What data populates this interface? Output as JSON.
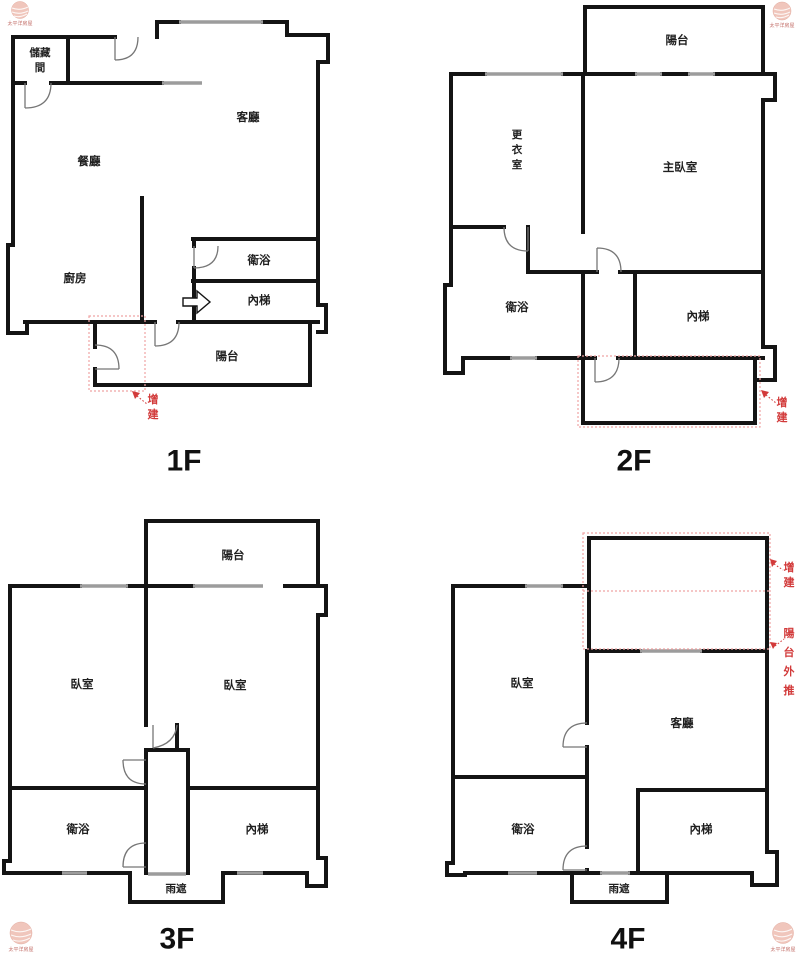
{
  "watermark": {
    "label": "太平洋房屋"
  },
  "colors": {
    "wall": "#141414",
    "window": "#9c9c9c",
    "annotation_red": "#d23a3a",
    "dashed_red": "#efa3a3",
    "watermark_pink": "#f0c6bc"
  },
  "floors": [
    {
      "floor_label": "1F",
      "rooms": {
        "storage": {
          "label": "儲藏間",
          "lines": [
            "儲藏",
            "間"
          ]
        },
        "living": {
          "label": "客廳"
        },
        "dining": {
          "label": "餐廳"
        },
        "kitchen": {
          "label": "廚房"
        },
        "bath": {
          "label": "衛浴"
        },
        "stairs": {
          "label": "內梯"
        },
        "balcony": {
          "label": "陽台"
        }
      },
      "annotations": {
        "addition": {
          "label": "增建",
          "lines": [
            "增",
            "建"
          ]
        }
      }
    },
    {
      "floor_label": "2F",
      "rooms": {
        "balcony": {
          "label": "陽台"
        },
        "dressing": {
          "label": "更衣室",
          "lines": [
            "更",
            "衣",
            "室"
          ]
        },
        "master": {
          "label": "主臥室"
        },
        "bath": {
          "label": "衛浴"
        },
        "stairs": {
          "label": "內梯"
        }
      },
      "annotations": {
        "addition": {
          "label": "增建",
          "lines": [
            "增",
            "建"
          ]
        }
      }
    },
    {
      "floor_label": "3F",
      "rooms": {
        "balcony": {
          "label": "陽台"
        },
        "bedroom_left": {
          "label": "臥室"
        },
        "bedroom_right": {
          "label": "臥室"
        },
        "bath": {
          "label": "衛浴"
        },
        "stairs": {
          "label": "內梯"
        },
        "canopy": {
          "label": "雨遮"
        }
      }
    },
    {
      "floor_label": "4F",
      "rooms": {
        "bedroom": {
          "label": "臥室"
        },
        "living": {
          "label": "客廳"
        },
        "bath": {
          "label": "衛浴"
        },
        "stairs": {
          "label": "內梯"
        },
        "canopy": {
          "label": "雨遮"
        }
      },
      "annotations": {
        "addition": {
          "label": "增建",
          "lines": [
            "增",
            "建"
          ]
        },
        "balcony_pushout": {
          "label": "陽台外推",
          "lines": [
            "陽",
            "台",
            "外",
            "推"
          ]
        }
      }
    }
  ]
}
